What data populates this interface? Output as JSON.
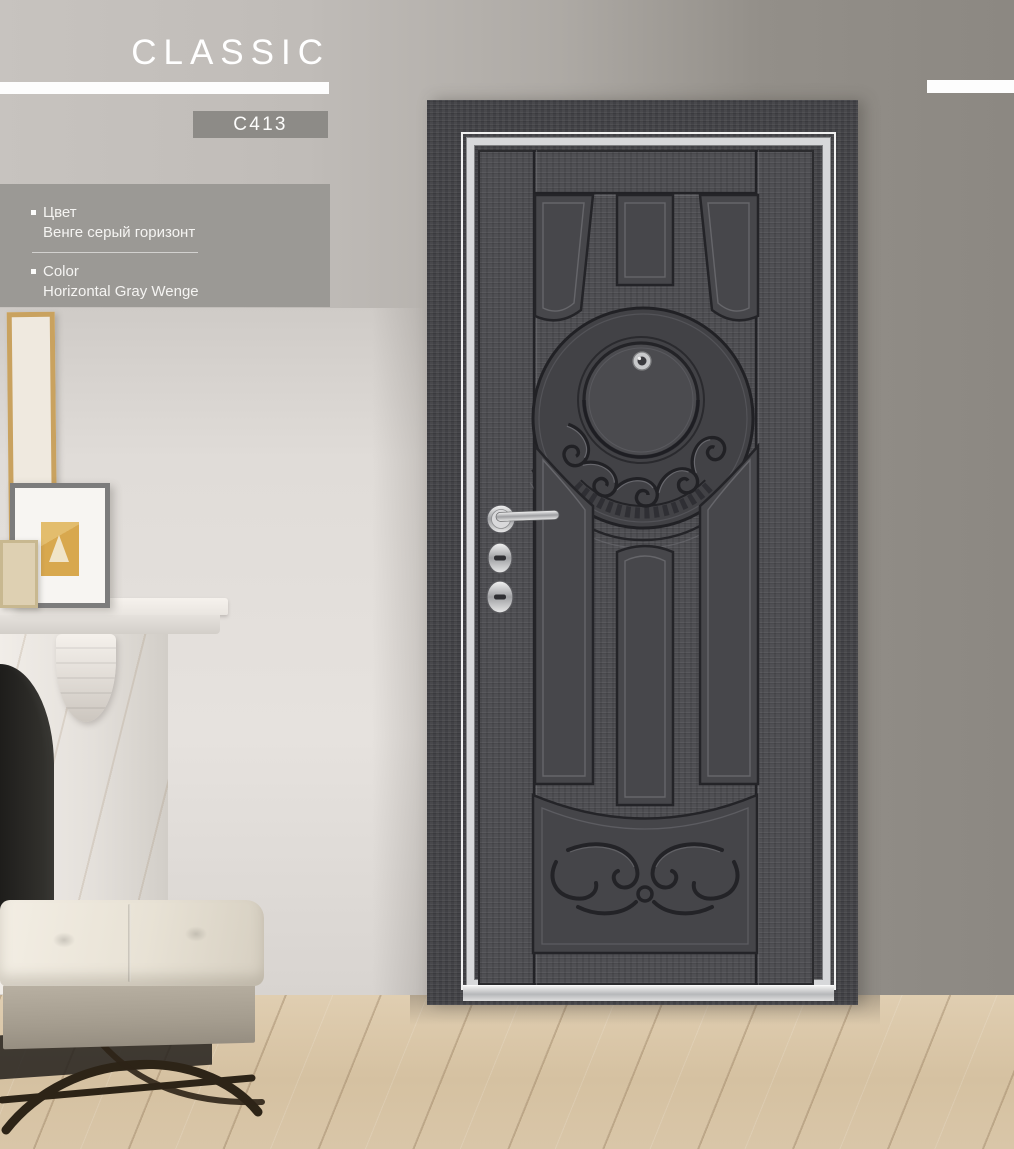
{
  "page": {
    "title": "CLASSIC",
    "model_code": "C413"
  },
  "specs": {
    "ru": {
      "label": "Цвет",
      "value": "Венге серый горизонт"
    },
    "en": {
      "label": "Color",
      "value": "Horizontal Gray Wenge"
    }
  },
  "palette": {
    "title_text": "#ffffff",
    "header_bar": "#fdfdfd",
    "badge_bg": "#8d8b87",
    "info_box_bg": "#9b9995",
    "door_wood": "#4a4a4e",
    "door_trim_silver": "#d7d8da",
    "wall_left": "#c6c2be",
    "wall_right": "#8f8b85",
    "floor_wood": "#d7c3a4"
  }
}
